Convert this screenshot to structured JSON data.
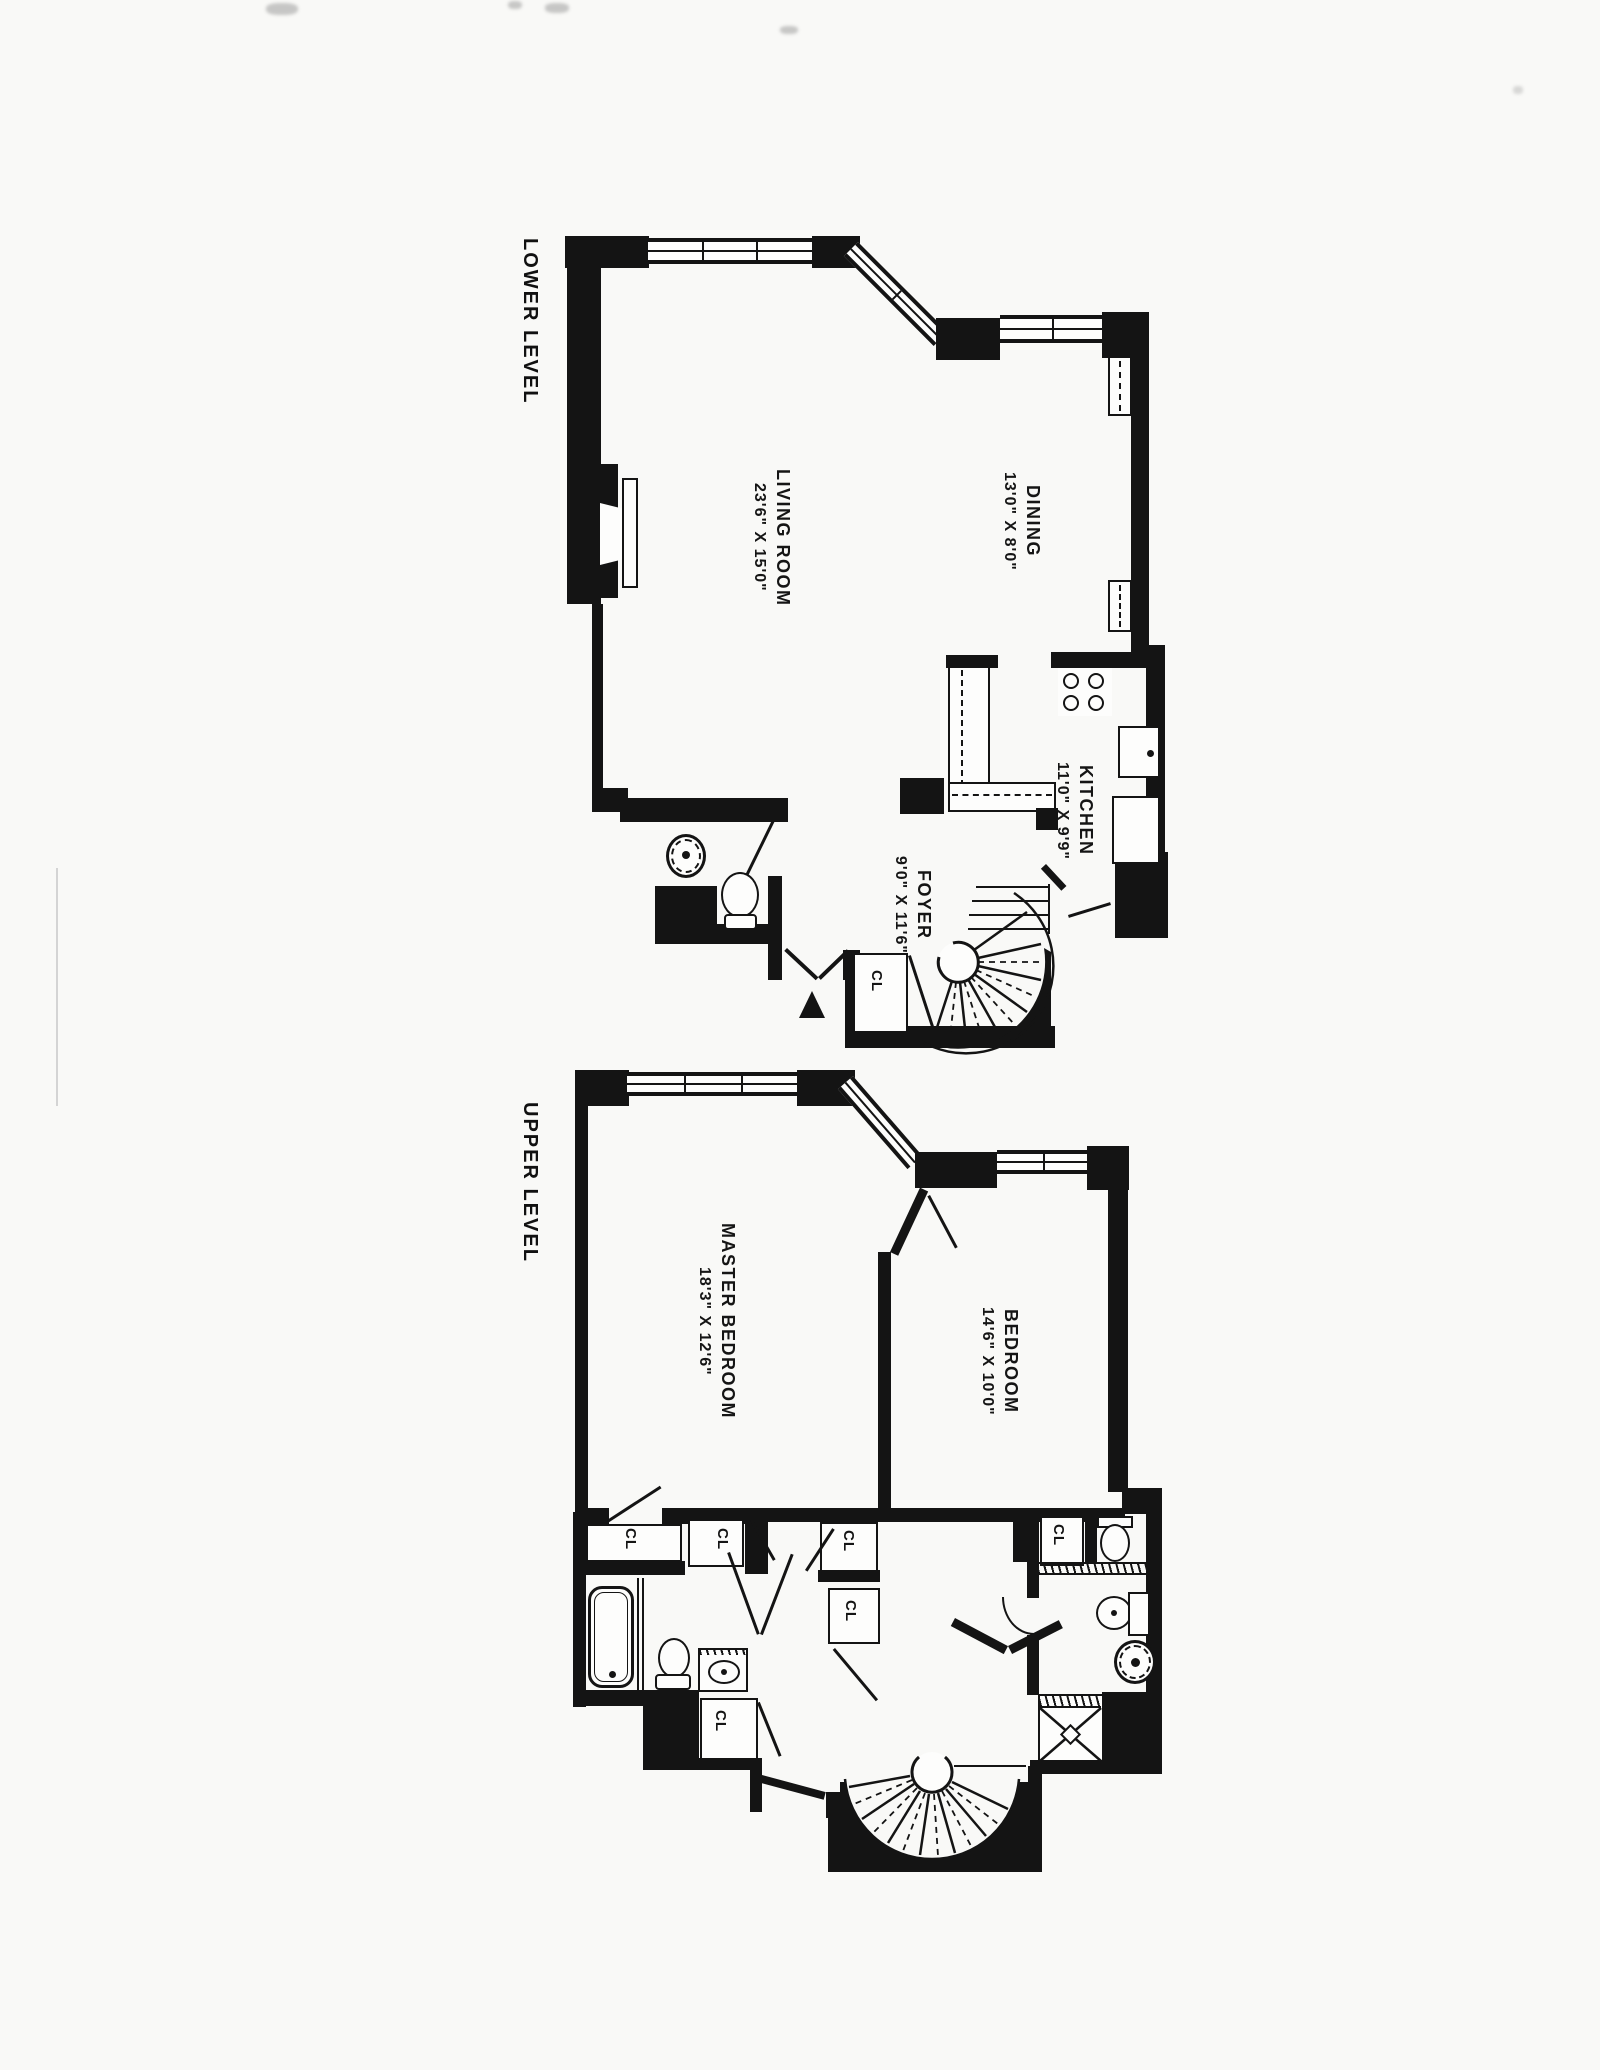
{
  "document": {
    "type": "floor-plan-scan"
  },
  "colors": {
    "ink": "#141414",
    "paper": "#f9f9f7"
  },
  "lower_level": {
    "title": "LOWER LEVEL",
    "rooms": [
      {
        "name": "LIVING ROOM",
        "dims": "23'6\" X 15'0\""
      },
      {
        "name": "DINING",
        "dims": "13'0\" X 8'0\""
      },
      {
        "name": "KITCHEN",
        "dims": "11'0\" X 9'9\""
      },
      {
        "name": "FOYER",
        "dims": "9'0\" X 11'6\""
      }
    ],
    "closets": [
      "CL"
    ]
  },
  "upper_level": {
    "title": "UPPER LEVEL",
    "rooms": [
      {
        "name": "MASTER BEDROOM",
        "dims": "18'3\" X 12'6\""
      },
      {
        "name": "BEDROOM",
        "dims": "14'6\" X 10'0\""
      }
    ],
    "closets": [
      "CL",
      "CL",
      "CL",
      "CL",
      "CL",
      "CL"
    ]
  }
}
